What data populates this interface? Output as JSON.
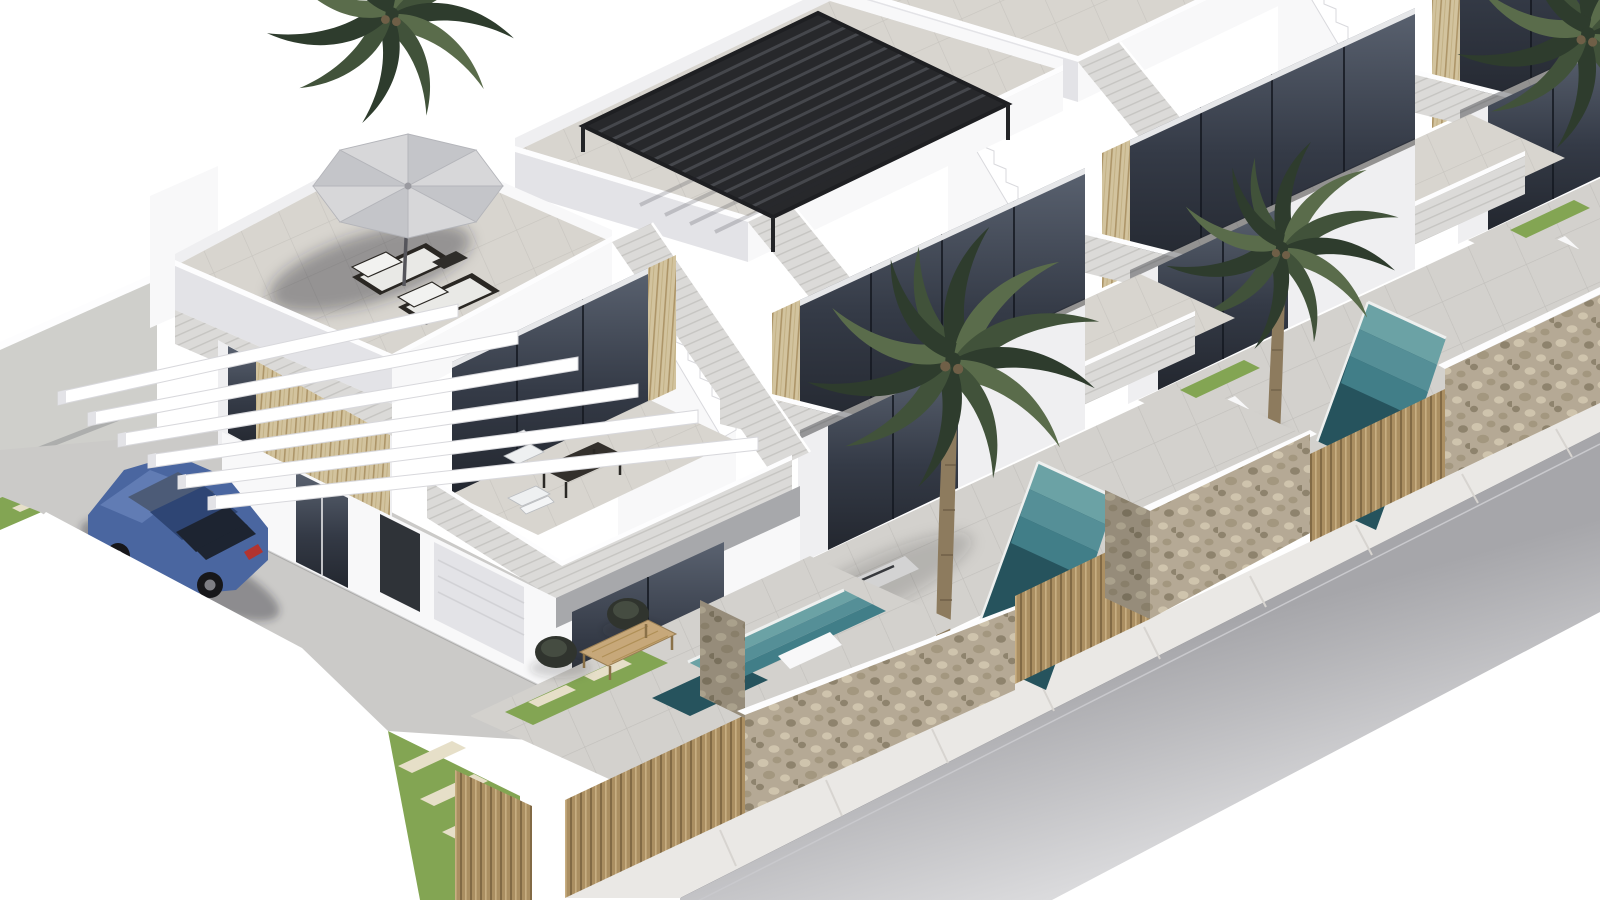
{
  "scene": {
    "type": "3d-architectural-exterior-render",
    "view": "isometric aerial",
    "description": "Photorealistic 3D rendering of a row of modern white two-storey townhouses with rooftop terraces, a parasol with sun loungers on the first roof, a black louvred pergola on the second, palm trees, small turquoise plunge pools behind a natural stone street wall with timber slat gates, a blue sedan parked under white pergola beams on the left driveway, and an empty grey street with pale sidewalk along the lower right."
  },
  "objects": {
    "townhouses": 4,
    "palm_trees": 4,
    "plunge_pools": 3,
    "vehicles": 1,
    "house_1_roof": "grey parasol with two dark sun loungers",
    "house_2_roof": "black louvred pergola",
    "street_boundary": "natural stone walls alternating with vertical timber slat gates",
    "left_boundary": "grey plot wall with white cantilevered carport beams",
    "furniture": [
      "balcony chairs with dark table",
      "two rattan lounge chairs",
      "timber coffee table"
    ],
    "landscaping": [
      "grass strips with pale stepping stones",
      "palm planting"
    ]
  },
  "colors": {
    "bg": "#ffffff",
    "wall-top": "#fdfdfe",
    "wall-lit": "#f8f8f9",
    "wall": "#efeff1",
    "wall-shade": "#e3e3e7",
    "wall-dim": "#cfcfcb",
    "siding": "#dbdad8",
    "siding-line": "#c6c5c2",
    "deck": "#d8d5cf",
    "deck-line": "#c8c5bf",
    "patio": "#d3d1cd",
    "patio-line": "#c2c0bc",
    "driveway": "#cbcac8",
    "sidewalk": "#eae8e5",
    "sidewalk-line": "#d7d4d0",
    "road": "#a6a6aa",
    "road-dark": "#88888d",
    "curb-light": "#c9c9cd",
    "glass-top": "#5a6270",
    "glass-mid": "#343a46",
    "glass-dark": "#23272f",
    "frame": "#e6e7e9",
    "slat-base": "#d2c39e",
    "slat-line": "#ad9568",
    "fence-base": "#ab8f62",
    "fence-dark": "#826a45",
    "fence-light": "#c8ae82",
    "stone-base": "#b5a995",
    "stone-light": "#cfc4ad",
    "stone-mid": "#a3977f",
    "stone-dark": "#8e836d",
    "pool-step1": "#6ba2a5",
    "pool-step2": "#558f97",
    "pool-step3": "#417e88",
    "pool-deep": "#26535d",
    "pool-coping": "#eef0ef",
    "grass": "#83a553",
    "grass-light": "#95b463",
    "slab": "#e6dfc8",
    "palm-dark": "#2e3c2d",
    "palm-mid": "#41523a",
    "palm-light": "#5a6c4b",
    "trunk": "#8d7b5e",
    "trunk-dark": "#6f5f47",
    "car-body": "#4a66a0",
    "car-body-light": "#617cb4",
    "car-roof": "#2e4574",
    "car-glass": "#1d2431",
    "car-glass-light": "#4c5b77",
    "wheel": "#17171a",
    "rim": "#7e7e84",
    "taillight": "#b23430",
    "pergola": "#27282b",
    "pergola-slat": "#45474c",
    "umbrella": "#d7d7d9",
    "umbrella-shade": "#c4c5c9",
    "umbrella-rib": "#b4b5ba",
    "umbrella-pole": "#55555b",
    "shadow": "rgba(40,44,52,0.18)",
    "shadow-strong": "rgba(35,38,46,0.38)"
  }
}
